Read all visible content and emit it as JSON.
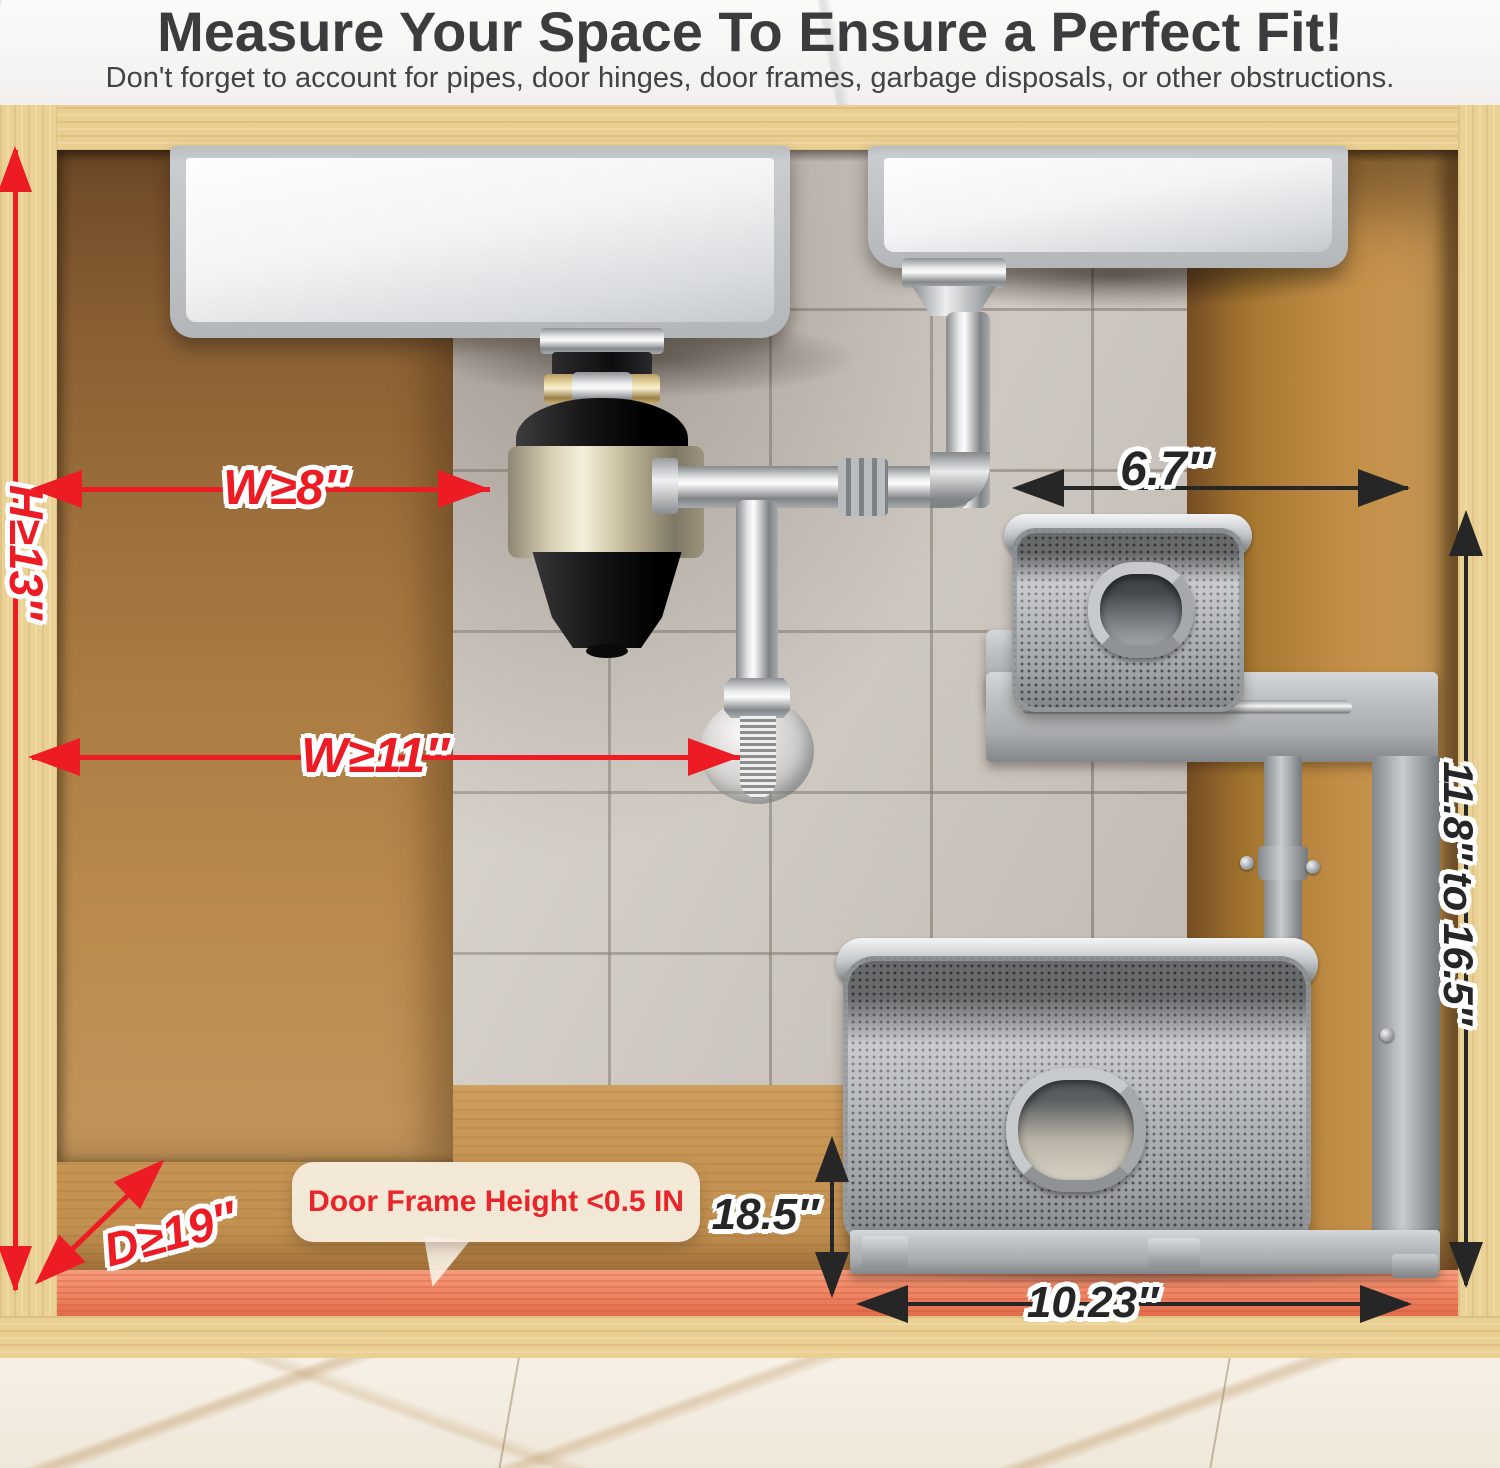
{
  "header": {
    "title": "Measure Your Space To Ensure a Perfect Fit!",
    "subtitle": "Don't forget to account for pipes, door hinges, door frames, garbage disposals, or other obstructions."
  },
  "measurements": {
    "cabinet_height": "H≥13″",
    "width_to_disposal": "W≥8″",
    "width_to_drain": "W≥11″",
    "cabinet_depth": "D≥19″",
    "top_shelf_clearance": "6.7″",
    "adjustable_height": "11.8″ to 16.5″",
    "basket_height_clearance": "18.5″",
    "basket_width": "10.23″"
  },
  "callout": {
    "door_frame_note": "Door Frame Height <0.5 IN"
  },
  "colors": {
    "red_accent": "#ed1c24",
    "black_arrow": "#262626",
    "salmon_strip": "#ef8766",
    "wood_light": "#e9cf92",
    "wood_dark": "#a4763f",
    "tile": "#d6cfc7"
  }
}
